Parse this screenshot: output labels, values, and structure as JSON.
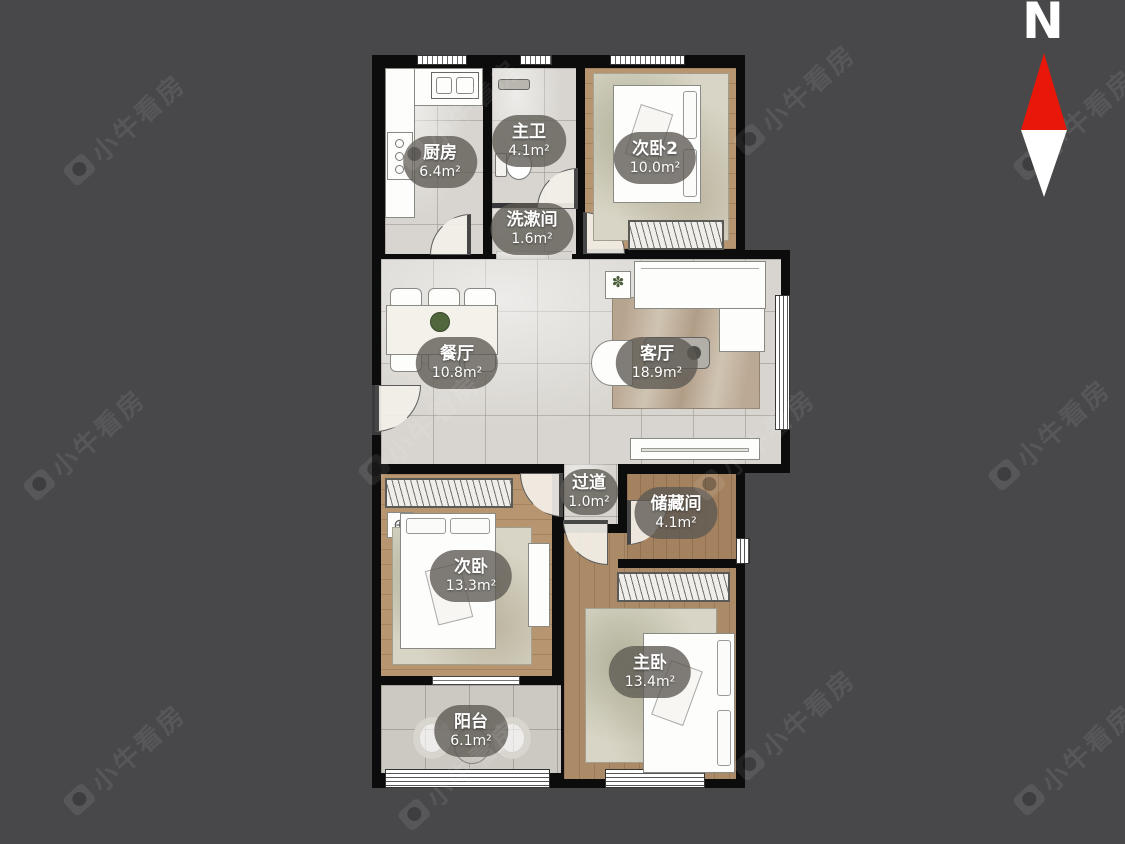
{
  "watermark": {
    "text": "小牛看房"
  },
  "compass": {
    "label": "N"
  },
  "colors": {
    "background": "#48484a",
    "wall": "#0c0c0d",
    "tile_floor": "#d8d5d0",
    "wood_floor": "#b79571",
    "label_pill": "#5c5852",
    "compass_red": "#e8170a",
    "compass_white": "#ffffff"
  },
  "rooms": [
    {
      "id": "kitchen",
      "name": "厨房",
      "area": "6.4m²"
    },
    {
      "id": "master-bath",
      "name": "主卫",
      "area": "4.1m²"
    },
    {
      "id": "bedroom-2",
      "name": "次卧2",
      "area": "10.0m²"
    },
    {
      "id": "washroom",
      "name": "洗漱间",
      "area": "1.6m²"
    },
    {
      "id": "dining-room",
      "name": "餐厅",
      "area": "10.8m²"
    },
    {
      "id": "living-room",
      "name": "客厅",
      "area": "18.9m²"
    },
    {
      "id": "hallway",
      "name": "过道",
      "area": "1.0m²"
    },
    {
      "id": "storage-room",
      "name": "储藏间",
      "area": "4.1m²"
    },
    {
      "id": "second-bedroom",
      "name": "次卧",
      "area": "13.3m²"
    },
    {
      "id": "master-bedroom",
      "name": "主卧",
      "area": "13.4m²"
    },
    {
      "id": "balcony",
      "name": "阳台",
      "area": "6.1m²"
    }
  ]
}
